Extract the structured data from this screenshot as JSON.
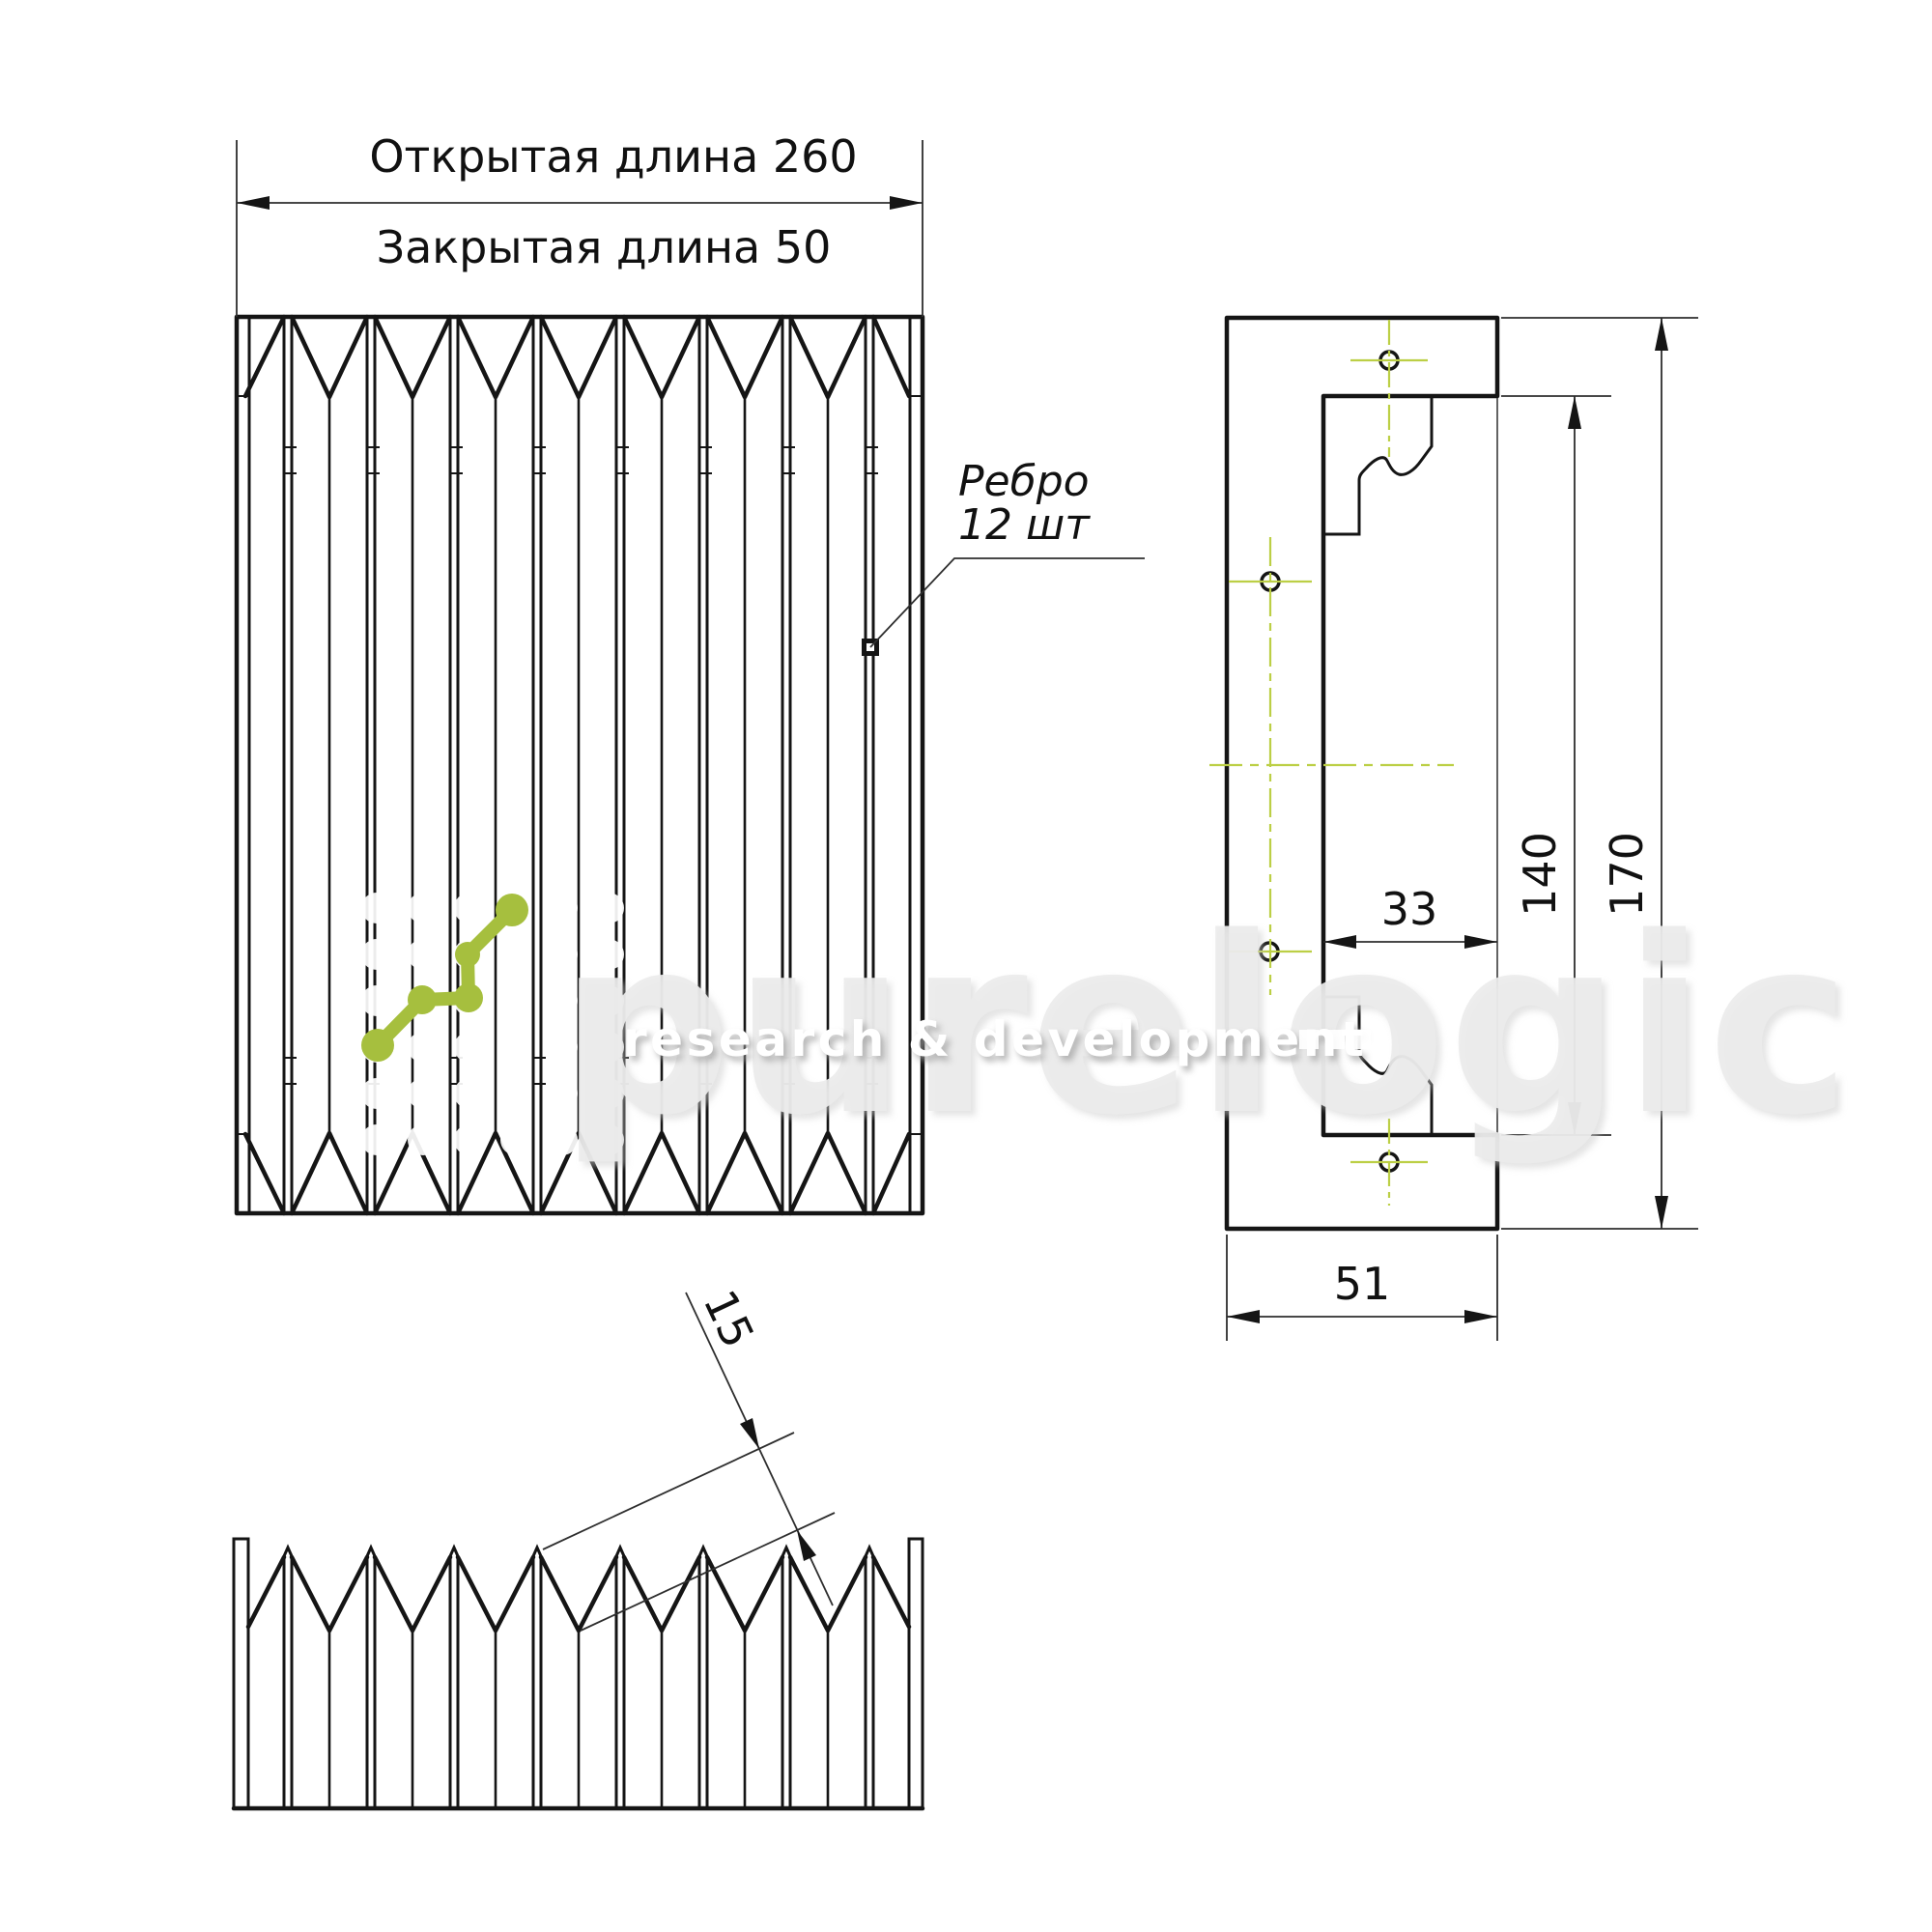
{
  "colors": {
    "line": "#151515",
    "thin_line": "#2e2e2e",
    "centerline_green": "#bccf45",
    "logo_green": "#a6bf3e",
    "watermark_gray": "#ececec",
    "background": "#ffffff"
  },
  "front_view": {
    "dim_open": "Открытая длина 260",
    "dim_closed": "Закрытая длина 50"
  },
  "rib_note": {
    "line1": "Ребро",
    "line2": "12 шт"
  },
  "side_view": {
    "dim_inner_height": "140",
    "dim_outer_height": "170",
    "dim_inner_width": "33",
    "dim_outer_width": "51"
  },
  "bottom_view": {
    "dim_fold_height": "15"
  },
  "watermark": {
    "brand": "purelogic",
    "tagline": "research & development"
  }
}
